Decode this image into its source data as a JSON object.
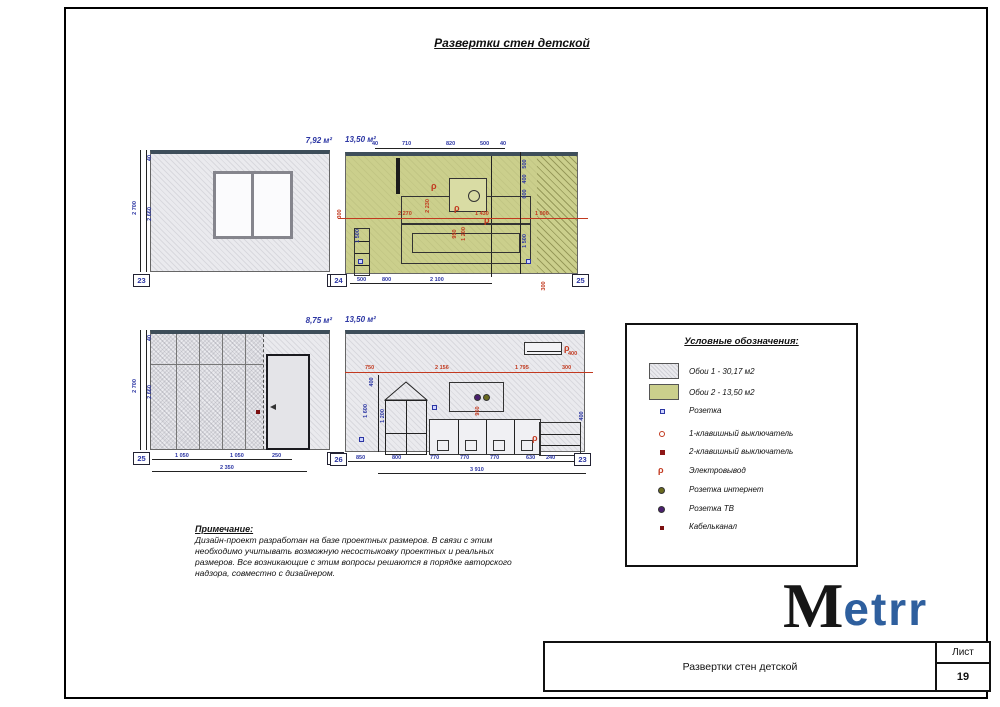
{
  "sheet": {
    "title": "Развертки стен детской",
    "logo": {
      "black": "M",
      "blue": "etrr"
    },
    "title_block": {
      "name": "Развертки стен детской",
      "sheet_label": "Лист",
      "sheet_number": "19"
    }
  },
  "elevations": {
    "wall_23_24": {
      "area": "7,92 м²",
      "marker_left": "23",
      "marker_right": "24",
      "height_outer": "2 700",
      "height_inner": "2 660",
      "top_gap": "40"
    },
    "wall_24_25": {
      "area": "13,50 м²",
      "marker_left": "24",
      "marker_right": "25",
      "dims_top": [
        "40",
        "710",
        "820",
        "500",
        "40"
      ],
      "dims_mid": [
        "300",
        "2 270",
        "1 430",
        "1 000"
      ],
      "dims_right_chain": [
        "500",
        "400",
        "600",
        "1 500"
      ],
      "dims_left_chain": [
        "1 500"
      ],
      "dims_center_rot": [
        "2 230",
        "950",
        "1 200"
      ],
      "dims_bottom": [
        "500",
        "800",
        "2 100"
      ],
      "dim_bottom_rot": "300"
    },
    "wall_25_26": {
      "area": "8,75 м²",
      "marker_left": "25",
      "marker_right": "26",
      "height_outer": "2 700",
      "height_inner": "2 660",
      "top_gap": "40",
      "dims_bottom": [
        "1 050",
        "1 050",
        "250"
      ],
      "dim_total": "2 350"
    },
    "wall_26_23": {
      "area": "13,50 м²",
      "marker_left": "26",
      "marker_right": "23",
      "dims_top": [
        "750",
        "2 156",
        "1 795",
        "300"
      ],
      "dim_ac": "400",
      "dims_left_chain": [
        "400",
        "1 600",
        "1 200"
      ],
      "dims_center_rot": [
        "950"
      ],
      "dims_right": [
        "400"
      ],
      "dims_bottom": [
        "850",
        "800",
        "770",
        "770",
        "770",
        "630",
        "240"
      ],
      "dim_total": "3 910"
    }
  },
  "legend": {
    "title": "Условные обозначения:",
    "items": [
      {
        "icon": "wallpaper-1-swatch",
        "label": "Обои 1 - 30,17 м2"
      },
      {
        "icon": "wallpaper-2-swatch",
        "label": "Обои 2 - 13,50 м2"
      },
      {
        "icon": "socket-icon",
        "label": "Розетка"
      },
      {
        "icon": "switch-1key-icon",
        "label": "1-клавишный выключатель"
      },
      {
        "icon": "switch-2key-icon",
        "label": "2-клавишный выключатель"
      },
      {
        "icon": "electric-outlet-icon",
        "label": "Электровывод"
      },
      {
        "icon": "internet-socket-icon",
        "label": "Розетка интернет"
      },
      {
        "icon": "tv-socket-icon",
        "label": "Розетка ТВ"
      },
      {
        "icon": "cable-channel-icon",
        "label": "Кабельканал"
      }
    ]
  },
  "notes": {
    "title": "Примечание:",
    "body": "Дизайн-проект разработан на базе проектных размеров. В связи с этим необходимо учитывать возможную несостыковку проектных и реальных размеров. Все возникающие с этим вопросы решаются в порядке авторского надзора, совместно с дизайнером."
  },
  "colors": {
    "wallpaper_1": "#eaeaee",
    "wallpaper_2": "#cbcf8c",
    "dim_red": "#c2391f",
    "dim_blue": "#2b35a3",
    "logo_blue": "#2e5f9e",
    "band_dark": "#3e4e5a"
  }
}
